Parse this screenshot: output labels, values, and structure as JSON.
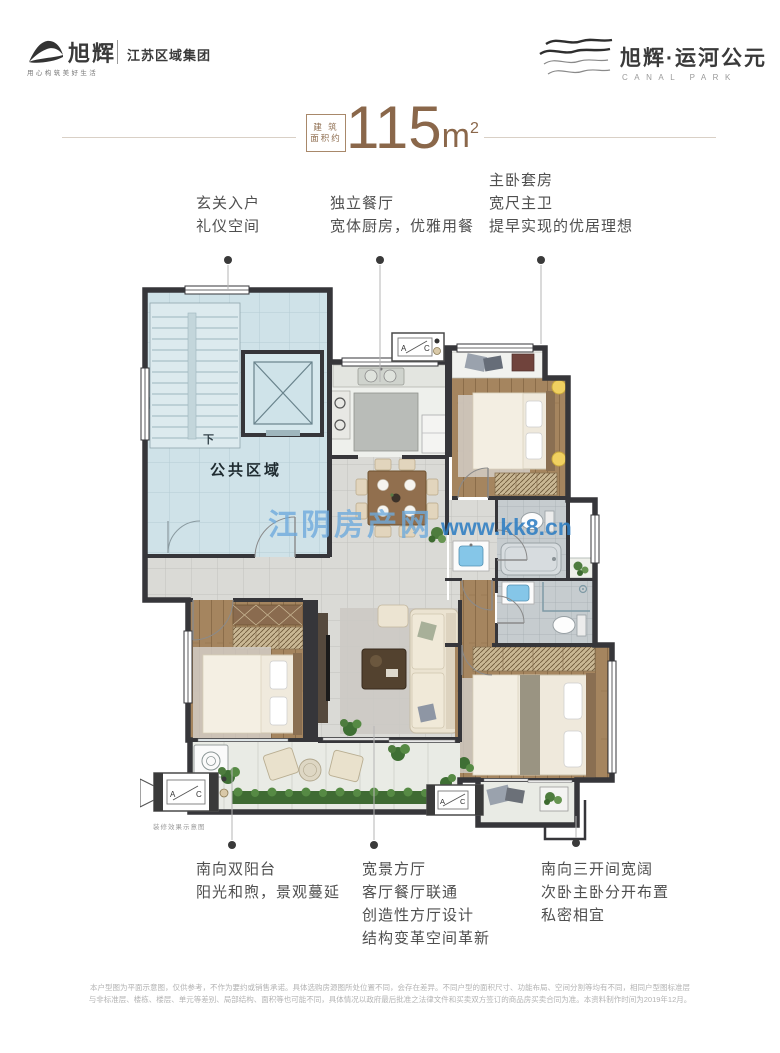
{
  "header": {
    "brand_left": {
      "name": "旭辉",
      "tagline": "用心构筑美好生活",
      "division": "江苏区域集团"
    },
    "brand_right": {
      "name": "旭辉·运河公元",
      "subtitle": "CANAL PARK"
    }
  },
  "title": {
    "prefix_line1": "建 筑",
    "prefix_line2": "面积约",
    "value": "115",
    "unit": "m",
    "unit_sup": "2"
  },
  "annotations_top": [
    {
      "lines": [
        "玄关入户",
        "礼仪空间"
      ]
    },
    {
      "lines": [
        "独立餐厅",
        "宽体厨房，优雅用餐"
      ]
    },
    {
      "lines": [
        "主卧套房",
        "宽尺主卫",
        "提早实现的优居理想"
      ]
    }
  ],
  "annotations_bottom": [
    {
      "lines": [
        "南向双阳台",
        "阳光和煦，景观蔓延"
      ]
    },
    {
      "lines": [
        "宽景方厅",
        "客厅餐厅联通",
        "创造性方厅设计",
        "结构变革空间革新"
      ]
    },
    {
      "lines": [
        "南向三开间宽阔",
        "次卧主卧分开布置",
        "私密相宜"
      ]
    }
  ],
  "floorplan": {
    "labels": {
      "public_area": "公共区域",
      "stairs_down": "下",
      "ac_a": "A",
      "ac_c": "C",
      "decor_caption": "装修效果示意图"
    },
    "watermark": {
      "site_name": "江阴房产网",
      "site_url": "www.kk8.cn"
    }
  },
  "disclaimer": {
    "line1": "本户型图为平面示意图，仅供参考，不作为要约或销售承诺。具体选购房源图所处位置不同，会存在差异。不同户型的面积尺寸、功能布局、空间分割等均有不同，相同户型图标准层",
    "line2": "与非标准层、楼栋、楼层、单元等差别、局部结构、面积等也可能不同，具体情况以政府最后批准之法律文件和买卖双方签订的商品房买卖合同为准。本资料制作时间为2019年12月。"
  },
  "colors": {
    "accent_brown": "#8a674a",
    "wall": "#36363a",
    "public_blue": "#cfe2e8",
    "wood": "#a5855f",
    "tile_gray": "#dadad6",
    "greenery": "#3f6b33",
    "watermark_blue": "#3c88c8"
  }
}
